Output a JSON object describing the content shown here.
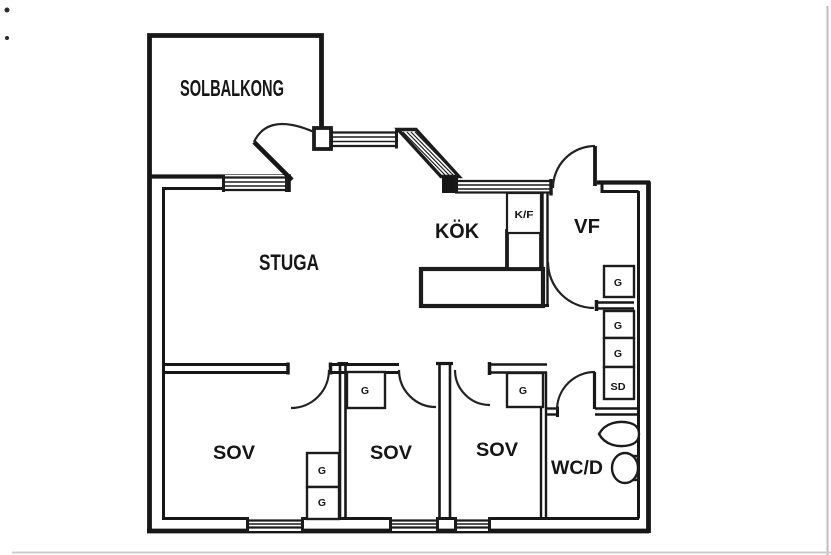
{
  "plan": {
    "type": "apartment-floor-plan",
    "colors": {
      "ink": "#171717",
      "paper": "#ffffff"
    },
    "rooms": {
      "solbalkong": "SOLBALKONG",
      "stuga": "STUGA",
      "kok": "KÖK",
      "vf": "VF",
      "sov_left": "SOV",
      "sov_middle": "SOV",
      "sov_right": "SOV",
      "wcd": "WC/D"
    },
    "closets": {
      "kf": "K/F",
      "g_vf": "G",
      "g_hall_upper": "G",
      "g_hall_lower": "G",
      "sd": "SD",
      "g_sov_left_upper": "G",
      "g_sov_left_lower": "G",
      "g_sov_middle": "G",
      "g_sov_right": "G"
    },
    "fixtures": {
      "sink": "sink",
      "toilet": "toilet"
    }
  }
}
